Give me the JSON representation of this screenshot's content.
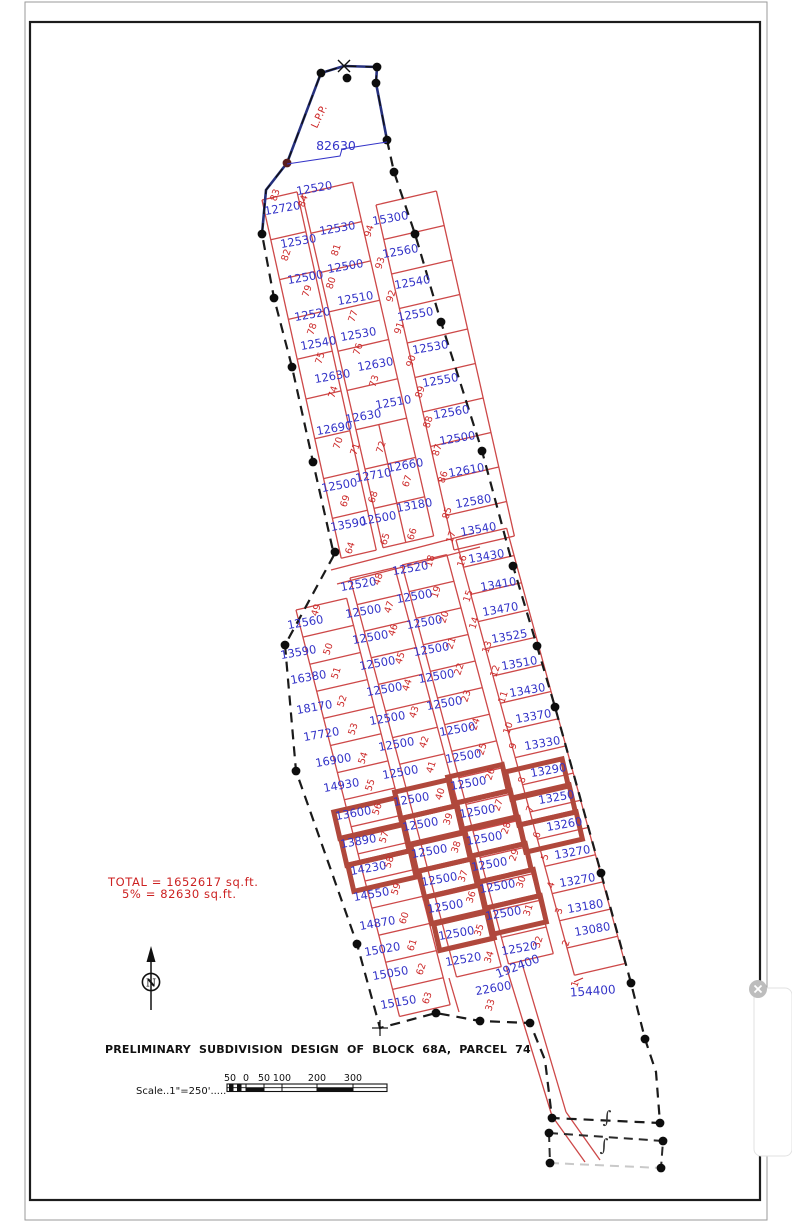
{
  "drawing": {
    "title": "PRELIMINARY SUBDIVISION DESIGN OF BLOCK 68A, PARCEL 74",
    "scale_label": "Scale..1\"=250'.....",
    "scale_ticks": [
      "50",
      "0",
      "50",
      "100",
      "200",
      "300"
    ],
    "total_line1": "TOTAL = 1652617 sq.ft.",
    "total_line2": "5% = 82630 sq.ft.",
    "north_label": "N",
    "lpp_label": "L.P.P.",
    "boundary_area_label": "82630",
    "road_area_label": "192400",
    "section_symbol": "∫"
  },
  "colors": {
    "lot_area_text": "#3434c8",
    "lot_number_text": "#cc2a2a",
    "lot_lines": "#cd4848",
    "highlight": "#b0483c",
    "boundary": "#1a1a1a",
    "boundary_navy": "#25307e",
    "annotation_red": "#cc2222"
  },
  "lots": [
    {
      "id": "83",
      "area": "12720",
      "hl": false,
      "nx": 278,
      "ny": 196,
      "ax": 283,
      "ay": 212
    },
    {
      "id": "82",
      "area": "12530",
      "hl": false,
      "nx": 289,
      "ny": 256,
      "ax": 299,
      "ay": 245
    },
    {
      "id": "79",
      "area": "12500",
      "hl": false,
      "nx": 310,
      "ny": 292,
      "ax": 306,
      "ay": 281
    },
    {
      "id": "78",
      "area": "12520",
      "hl": false,
      "nx": 315,
      "ny": 330,
      "ax": 313,
      "ay": 318
    },
    {
      "id": "75",
      "area": "12540",
      "hl": false,
      "nx": 323,
      "ny": 359,
      "ax": 319,
      "ay": 347
    },
    {
      "id": "74",
      "area": "12630",
      "hl": false,
      "nx": 336,
      "ny": 393,
      "ax": 333,
      "ay": 380
    },
    {
      "id": "70",
      "area": "12690",
      "hl": false,
      "nx": 341,
      "ny": 444,
      "ax": 335,
      "ay": 432
    },
    {
      "id": "69",
      "area": "12500",
      "hl": false,
      "nx": 348,
      "ny": 502,
      "ax": 340,
      "ay": 489
    },
    {
      "id": "64",
      "area": "13590",
      "hl": false,
      "nx": 353,
      "ny": 549,
      "ax": 349,
      "ay": 528
    },
    {
      "id": "84",
      "area": "12520",
      "hl": false,
      "nx": 306,
      "ny": 202,
      "ax": 315,
      "ay": 192
    },
    {
      "id": "81",
      "area": "12530",
      "hl": false,
      "nx": 339,
      "ny": 251,
      "ax": 338,
      "ay": 232
    },
    {
      "id": "80",
      "area": "12500",
      "hl": false,
      "nx": 334,
      "ny": 284,
      "ax": 346,
      "ay": 270
    },
    {
      "id": "77",
      "area": "12510",
      "hl": false,
      "nx": 356,
      "ny": 317,
      "ax": 356,
      "ay": 302
    },
    {
      "id": "76",
      "area": "12530",
      "hl": false,
      "nx": 361,
      "ny": 350,
      "ax": 359,
      "ay": 338
    },
    {
      "id": "73",
      "area": "12630",
      "hl": false,
      "nx": 377,
      "ny": 382,
      "ax": 376,
      "ay": 368
    },
    {
      "id": "71",
      "area": "12630",
      "hl": false,
      "nx": 358,
      "ny": 450,
      "ax": 364,
      "ay": 420
    },
    {
      "id": "72",
      "area": "12510",
      "hl": false,
      "nx": 384,
      "ny": 448,
      "ax": 394,
      "ay": 406
    },
    {
      "id": "68",
      "area": "12710",
      "hl": false,
      "nx": 376,
      "ny": 498,
      "ax": 374,
      "ay": 479
    },
    {
      "id": "67",
      "area": "12660",
      "hl": false,
      "nx": 410,
      "ny": 482,
      "ax": 406,
      "ay": 469
    },
    {
      "id": "65",
      "area": "12500",
      "hl": false,
      "nx": 388,
      "ny": 540,
      "ax": 379,
      "ay": 522
    },
    {
      "id": "66",
      "area": "13180",
      "hl": false,
      "nx": 415,
      "ny": 535,
      "ax": 415,
      "ay": 509
    },
    {
      "id": "94",
      "area": "15300",
      "hl": false,
      "nx": 372,
      "ny": 232,
      "ax": 391,
      "ay": 222
    },
    {
      "id": "93",
      "area": "12560",
      "hl": false,
      "nx": 383,
      "ny": 264,
      "ax": 401,
      "ay": 255
    },
    {
      "id": "92",
      "area": "12540",
      "hl": false,
      "nx": 394,
      "ny": 297,
      "ax": 413,
      "ay": 286
    },
    {
      "id": "91",
      "area": "12550",
      "hl": false,
      "nx": 402,
      "ny": 329,
      "ax": 416,
      "ay": 318
    },
    {
      "id": "90",
      "area": "12530",
      "hl": false,
      "nx": 414,
      "ny": 362,
      "ax": 431,
      "ay": 351
    },
    {
      "id": "89",
      "area": "12550",
      "hl": false,
      "nx": 423,
      "ny": 393,
      "ax": 441,
      "ay": 384
    },
    {
      "id": "88",
      "area": "12560",
      "hl": false,
      "nx": 431,
      "ny": 423,
      "ax": 452,
      "ay": 416
    },
    {
      "id": "87",
      "area": "12500",
      "hl": false,
      "nx": 440,
      "ny": 451,
      "ax": 458,
      "ay": 442
    },
    {
      "id": "86",
      "area": "12610",
      "hl": false,
      "nx": 446,
      "ny": 478,
      "ax": 467,
      "ay": 474
    },
    {
      "id": "85",
      "area": "12580",
      "hl": false,
      "nx": 450,
      "ny": 514,
      "ax": 474,
      "ay": 505
    },
    {
      "id": "49",
      "area": "12560",
      "hl": false,
      "nx": 319,
      "ny": 611,
      "ax": 306,
      "ay": 626
    },
    {
      "id": "50",
      "area": "13590",
      "hl": false,
      "nx": 331,
      "ny": 650,
      "ax": 299,
      "ay": 656
    },
    {
      "id": "51",
      "area": "16380",
      "hl": false,
      "nx": 339,
      "ny": 674,
      "ax": 309,
      "ay": 681
    },
    {
      "id": "52",
      "area": "18170",
      "hl": false,
      "nx": 345,
      "ny": 702,
      "ax": 315,
      "ay": 711
    },
    {
      "id": "53",
      "area": "17720",
      "hl": false,
      "nx": 356,
      "ny": 730,
      "ax": 322,
      "ay": 738
    },
    {
      "id": "54",
      "area": "16900",
      "hl": false,
      "nx": 366,
      "ny": 759,
      "ax": 334,
      "ay": 764
    },
    {
      "id": "55",
      "area": "14930",
      "hl": false,
      "nx": 373,
      "ny": 786,
      "ax": 342,
      "ay": 789
    },
    {
      "id": "56",
      "area": "13600",
      "hl": true,
      "nx": 380,
      "ny": 810,
      "ax": 354,
      "ay": 817
    },
    {
      "id": "57",
      "area": "13890",
      "hl": true,
      "nx": 387,
      "ny": 838,
      "ax": 359,
      "ay": 845
    },
    {
      "id": "58",
      "area": "14230",
      "hl": true,
      "nx": 392,
      "ny": 863,
      "ax": 369,
      "ay": 872
    },
    {
      "id": "59",
      "area": "14550",
      "hl": false,
      "nx": 399,
      "ny": 890,
      "ax": 372,
      "ay": 898
    },
    {
      "id": "60",
      "area": "14870",
      "hl": false,
      "nx": 407,
      "ny": 919,
      "ax": 378,
      "ay": 927
    },
    {
      "id": "61",
      "area": "15020",
      "hl": false,
      "nx": 415,
      "ny": 946,
      "ax": 383,
      "ay": 953
    },
    {
      "id": "62",
      "area": "15050",
      "hl": false,
      "nx": 424,
      "ny": 970,
      "ax": 391,
      "ay": 977
    },
    {
      "id": "63",
      "area": "15150",
      "hl": false,
      "nx": 430,
      "ny": 999,
      "ax": 399,
      "ay": 1006
    },
    {
      "id": "48",
      "area": "12520",
      "hl": false,
      "nx": 381,
      "ny": 580,
      "ax": 359,
      "ay": 588
    },
    {
      "id": "47",
      "area": "12500",
      "hl": false,
      "nx": 392,
      "ny": 608,
      "ax": 364,
      "ay": 615
    },
    {
      "id": "46",
      "area": "12500",
      "hl": false,
      "nx": 396,
      "ny": 631,
      "ax": 371,
      "ay": 641
    },
    {
      "id": "45",
      "area": "12500",
      "hl": false,
      "nx": 403,
      "ny": 659,
      "ax": 378,
      "ay": 667
    },
    {
      "id": "44",
      "area": "12500",
      "hl": false,
      "nx": 410,
      "ny": 686,
      "ax": 385,
      "ay": 693
    },
    {
      "id": "43",
      "area": "12500",
      "hl": false,
      "nx": 417,
      "ny": 713,
      "ax": 388,
      "ay": 722
    },
    {
      "id": "42",
      "area": "12500",
      "hl": false,
      "nx": 427,
      "ny": 743,
      "ax": 397,
      "ay": 748
    },
    {
      "id": "41",
      "area": "12500",
      "hl": false,
      "nx": 434,
      "ny": 768,
      "ax": 401,
      "ay": 776
    },
    {
      "id": "40",
      "area": "12500",
      "hl": true,
      "nx": 443,
      "ny": 795,
      "ax": 412,
      "ay": 803
    },
    {
      "id": "39",
      "area": "12500",
      "hl": true,
      "nx": 451,
      "ny": 820,
      "ax": 421,
      "ay": 828
    },
    {
      "id": "38",
      "area": "12500",
      "hl": true,
      "nx": 459,
      "ny": 848,
      "ax": 430,
      "ay": 855
    },
    {
      "id": "37",
      "area": "12500",
      "hl": true,
      "nx": 466,
      "ny": 877,
      "ax": 440,
      "ay": 883
    },
    {
      "id": "36",
      "area": "12500",
      "hl": true,
      "nx": 474,
      "ny": 898,
      "ax": 446,
      "ay": 910
    },
    {
      "id": "35",
      "area": "12500",
      "hl": true,
      "nx": 482,
      "ny": 931,
      "ax": 457,
      "ay": 937
    },
    {
      "id": "34",
      "area": "12520",
      "hl": false,
      "nx": 492,
      "ny": 958,
      "ax": 464,
      "ay": 963
    },
    {
      "id": "33",
      "area": "22600",
      "hl": false,
      "nx": 493,
      "ny": 1006,
      "ax": 494,
      "ay": 992
    },
    {
      "id": "18",
      "area": "12520",
      "hl": false,
      "nx": 433,
      "ny": 562,
      "ax": 411,
      "ay": 572
    },
    {
      "id": "19",
      "area": "12500",
      "hl": false,
      "nx": 439,
      "ny": 593,
      "ax": 415,
      "ay": 600
    },
    {
      "id": "20",
      "area": "12500",
      "hl": false,
      "nx": 447,
      "ny": 618,
      "ax": 425,
      "ay": 626
    },
    {
      "id": "21",
      "area": "12500",
      "hl": false,
      "nx": 454,
      "ny": 644,
      "ax": 432,
      "ay": 653
    },
    {
      "id": "22",
      "area": "12500",
      "hl": false,
      "nx": 462,
      "ny": 670,
      "ax": 437,
      "ay": 680
    },
    {
      "id": "23",
      "area": "12500",
      "hl": false,
      "nx": 469,
      "ny": 697,
      "ax": 445,
      "ay": 707
    },
    {
      "id": "24",
      "area": "12500",
      "hl": false,
      "nx": 478,
      "ny": 725,
      "ax": 458,
      "ay": 733
    },
    {
      "id": "25",
      "area": "12500",
      "hl": false,
      "nx": 485,
      "ny": 750,
      "ax": 464,
      "ay": 760
    },
    {
      "id": "26",
      "area": "12500",
      "hl": true,
      "nx": 493,
      "ny": 775,
      "ax": 469,
      "ay": 787
    },
    {
      "id": "27",
      "area": "12500",
      "hl": true,
      "nx": 501,
      "ny": 806,
      "ax": 478,
      "ay": 815
    },
    {
      "id": "28",
      "area": "12500",
      "hl": true,
      "nx": 509,
      "ny": 829,
      "ax": 485,
      "ay": 842
    },
    {
      "id": "29",
      "area": "12500",
      "hl": true,
      "nx": 517,
      "ny": 856,
      "ax": 490,
      "ay": 868
    },
    {
      "id": "30",
      "area": "12500",
      "hl": true,
      "nx": 524,
      "ny": 883,
      "ax": 498,
      "ay": 890
    },
    {
      "id": "31",
      "area": "12500",
      "hl": true,
      "nx": 531,
      "ny": 911,
      "ax": 504,
      "ay": 917
    },
    {
      "id": "32",
      "area": "12520",
      "hl": false,
      "nx": 541,
      "ny": 943,
      "ax": 520,
      "ay": 952
    },
    {
      "id": "17",
      "area": "13540",
      "hl": false,
      "nx": 454,
      "ny": 538,
      "ax": 479,
      "ay": 533
    },
    {
      "id": "16",
      "area": "13430",
      "hl": false,
      "nx": 465,
      "ny": 562,
      "ax": 487,
      "ay": 560
    },
    {
      "id": "15",
      "area": "13410",
      "hl": false,
      "nx": 471,
      "ny": 597,
      "ax": 499,
      "ay": 588
    },
    {
      "id": "14",
      "area": "13470",
      "hl": false,
      "nx": 477,
      "ny": 624,
      "ax": 501,
      "ay": 613
    },
    {
      "id": "13",
      "area": "13525",
      "hl": false,
      "nx": 490,
      "ny": 648,
      "ax": 510,
      "ay": 640
    },
    {
      "id": "12",
      "area": "13510",
      "hl": false,
      "nx": 498,
      "ny": 672,
      "ax": 520,
      "ay": 667
    },
    {
      "id": "11",
      "area": "13430",
      "hl": false,
      "nx": 506,
      "ny": 698,
      "ax": 528,
      "ay": 694
    },
    {
      "id": "10",
      "area": "13370",
      "hl": false,
      "nx": 511,
      "ny": 729,
      "ax": 534,
      "ay": 720
    },
    {
      "id": "9",
      "area": "13330",
      "hl": false,
      "nx": 516,
      "ny": 747,
      "ax": 543,
      "ay": 747
    },
    {
      "id": "8",
      "area": "13290",
      "hl": true,
      "nx": 525,
      "ny": 781,
      "ax": 549,
      "ay": 774
    },
    {
      "id": "7",
      "area": "13250",
      "hl": true,
      "nx": 533,
      "ny": 810,
      "ax": 557,
      "ay": 801
    },
    {
      "id": "6",
      "area": "13260",
      "hl": true,
      "nx": 540,
      "ny": 836,
      "ax": 565,
      "ay": 828
    },
    {
      "id": "5",
      "area": "13270",
      "hl": false,
      "nx": 548,
      "ny": 858,
      "ax": 573,
      "ay": 856
    },
    {
      "id": "4",
      "area": "13270",
      "hl": false,
      "nx": 554,
      "ny": 886,
      "ax": 578,
      "ay": 884
    },
    {
      "id": "3",
      "area": "13180",
      "hl": false,
      "nx": 562,
      "ny": 912,
      "ax": 586,
      "ay": 910
    },
    {
      "id": "2",
      "area": "13080",
      "hl": false,
      "nx": 569,
      "ny": 944,
      "ax": 593,
      "ay": 933
    },
    {
      "id": "1",
      "area": "154400",
      "hl": false,
      "nx": 578,
      "ny": 985,
      "ax": 593,
      "ay": 995
    }
  ]
}
